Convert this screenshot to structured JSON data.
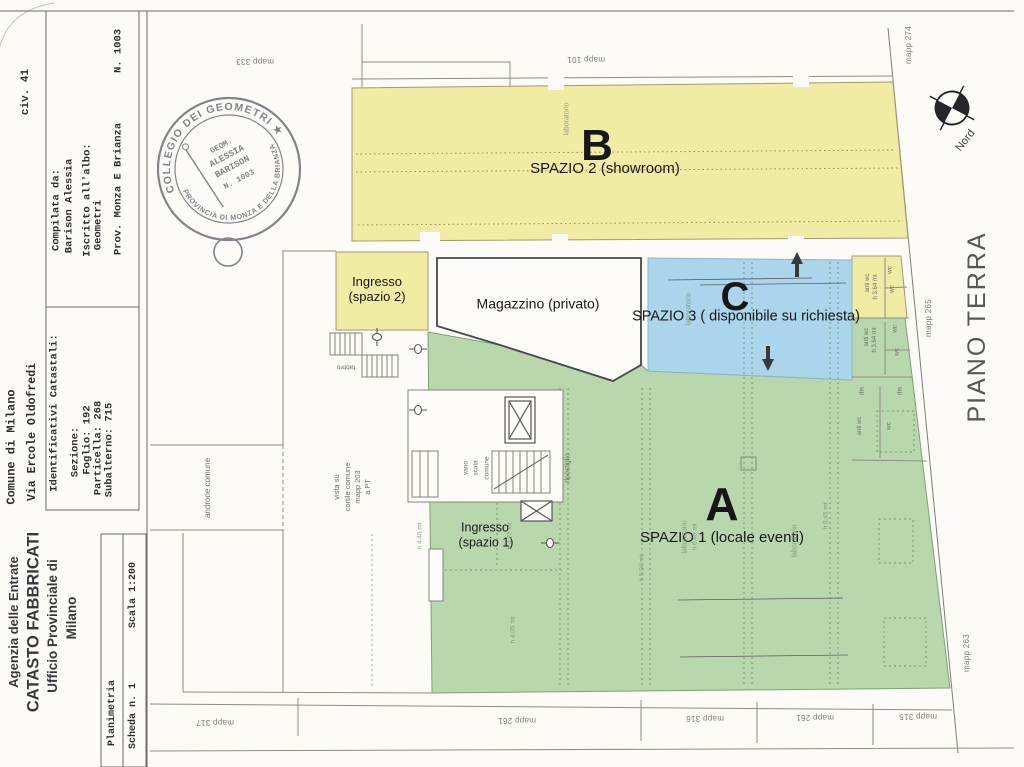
{
  "document": {
    "agency": [
      "Agenzia delle Entrate",
      "CATASTO FABBRICATI",
      "Ufficio Provinciale di",
      "Milano"
    ],
    "location": {
      "comune": "Comune di Milano",
      "via": "Via Ercole Oldofredi",
      "civ": "civ. 41"
    },
    "compiler": {
      "title": "Compilata da:",
      "name": "Barison Alessia",
      "register_label": "Iscritto all'albo:",
      "register": "Geometri",
      "province": "Prov. Monza E Brianza",
      "number": "N. 1003"
    },
    "cadastral": {
      "title": "Identificativi Catastali:",
      "sezione": "Sezione:",
      "foglio": "Foglio: 192",
      "particella": "Particella: 268",
      "subalterno": "Subalterno: 715"
    },
    "sheet": {
      "type": "Planimetria",
      "scheda": "Scheda n. 1",
      "scala": "Scala 1:200"
    }
  },
  "stamp": {
    "ring_top": "COLLEGIO DEI GEOMETRI ★",
    "ring_bottom": "PROVINCIA DI MONZA E DELLA BRIANZA",
    "inner": [
      "GEOM.",
      "ALESSIA",
      "BARISON",
      "N. 1003"
    ]
  },
  "plan": {
    "floor_label": "PIANO TERRA",
    "north_label": "Nord",
    "zones": {
      "b": {
        "letter": "B",
        "name": "SPAZIO 2 (showroom)",
        "color": "#f1eca3"
      },
      "c": {
        "letter": "C",
        "name": "SPAZIO 3 ( disponibile su richiesta)",
        "color": "#aad5eb"
      },
      "a": {
        "letter": "A",
        "name": "SPAZIO 1 (locale eventi)",
        "color": "#b9d7ad"
      }
    },
    "rooms": {
      "magazzino": "Magazzino (privato)",
      "ingresso2_l1": "Ingresso",
      "ingresso2_l2": "(spazio 2)",
      "ingresso1_l1": "Ingresso",
      "ingresso1_l2": "(spazio 1)",
      "vano_scala": [
        "vano",
        "scala",
        "comune"
      ],
      "ripostiglio": "ripostiglio",
      "androne": "androne comune",
      "cortile": [
        "vista su",
        "cortile comune",
        "mapp 203",
        "a PT"
      ],
      "fabbro": "fabbro",
      "anti_wc": "anti wc",
      "wc": "wc",
      "dis": "dis",
      "h364": "h 3.64 mt"
    },
    "heights": {
      "h645": "h 6.45 mt",
      "h446": "h 4.46 mt",
      "h437": "h 4.37 mt",
      "h504": "h 5.04 mt",
      "h405": "h 4.05 mt"
    },
    "laboratorio": "laboratorio",
    "mapp": {
      "m333": "mapp 333",
      "m101": "mapp 101",
      "m274": "mapp 274",
      "m265": "mapp 265",
      "m263": "mapp 263",
      "m317": "mapp 317",
      "m261": "mapp 261",
      "m316": "mapp 316",
      "m261b": "mapp 261",
      "m315": "mapp 315"
    }
  }
}
